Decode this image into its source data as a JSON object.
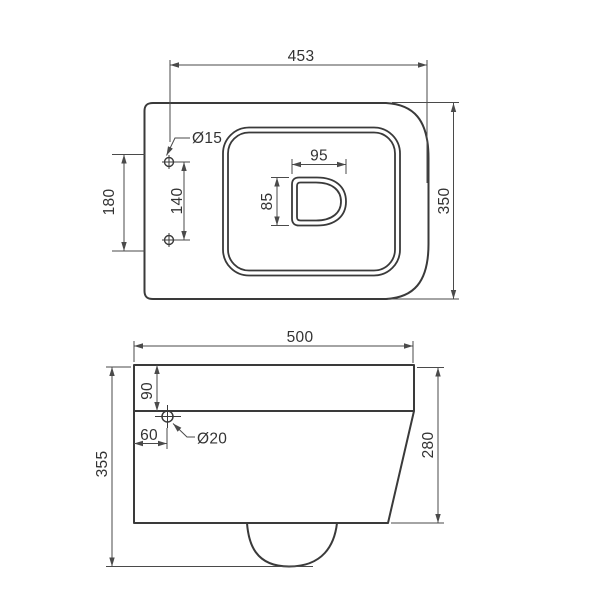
{
  "drawing": {
    "type": "technical-dimension-drawing",
    "subject": "wall-hung toilet",
    "units": "mm"
  },
  "colors": {
    "outline": "#3a3a3a",
    "dimension": "#4a4a4a",
    "text": "#333333",
    "background": "#ffffff"
  },
  "top_view": {
    "dims": {
      "width": "453",
      "depth": "350",
      "fixing_hole_diameter": "Ø15",
      "fixing_hole_span_outer": "180",
      "fixing_hole_span": "140",
      "outlet_width": "95",
      "outlet_height": "85"
    }
  },
  "side_view": {
    "dims": {
      "width": "500",
      "height_total": "355",
      "rim_height": "90",
      "fixing_hole_inset": "60",
      "fixing_hole_diameter": "Ø20",
      "front_height": "280"
    }
  }
}
